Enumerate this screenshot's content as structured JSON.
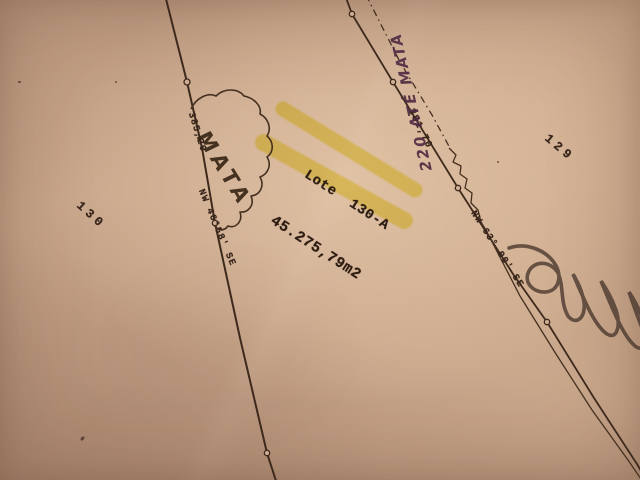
{
  "photo": {
    "labels": {
      "lot": "Lote  130-A",
      "area": "45.275,79m2",
      "parcel_left": "130",
      "parcel_right": "129",
      "forest": "MATA",
      "west_distance": "385,20",
      "west_bearing": "NW 46°58' SE",
      "road_distance": "381,70",
      "road_bearing": "NW 63° 00' SE",
      "note": "220 ATÉ MATA"
    },
    "colors": {
      "paper": "#c8a68b",
      "ink": "#3e2a1d",
      "highlight": "#ece53a",
      "note_ink": "#4e2a42",
      "pencil": "#4b382e"
    }
  }
}
